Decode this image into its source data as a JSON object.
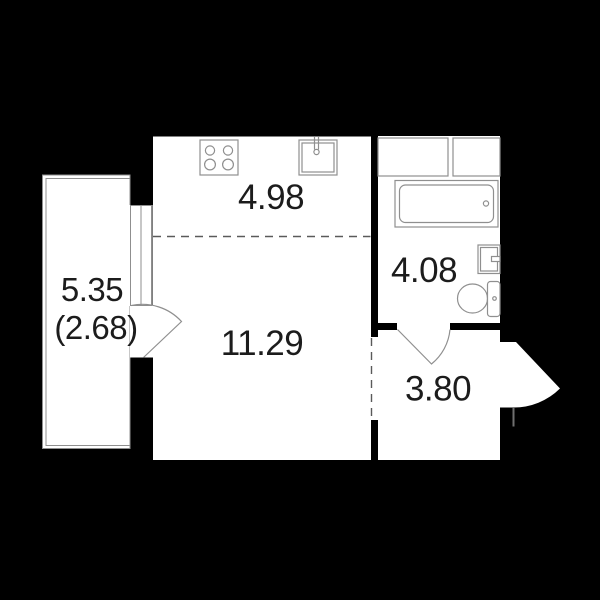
{
  "plan": {
    "title": "Studio apartment floor plan",
    "colors": {
      "background": "#000000",
      "walls": "#000000",
      "floor": "#ffffff",
      "fixture_lines": "#8f8f8f",
      "label_text": "#1c1c1c"
    },
    "rooms": {
      "kitchen": {
        "area": "4.98",
        "icons": [
          "stove-icon",
          "kitchen-sink-icon"
        ]
      },
      "living_room": {
        "area": "11.29"
      },
      "bathroom": {
        "area": "4.08",
        "icons": [
          "bathtub-icon",
          "washbasin-icon",
          "toilet-icon",
          "cabinet-icon"
        ]
      },
      "hallway": {
        "area": "3.80",
        "icons": [
          "door-swing-icon",
          "entrance-arrow-icon"
        ]
      },
      "balcony": {
        "area": "5.35",
        "area_reduced": "(2.68)",
        "icons": [
          "window-icon",
          "door-swing-icon"
        ]
      }
    }
  }
}
